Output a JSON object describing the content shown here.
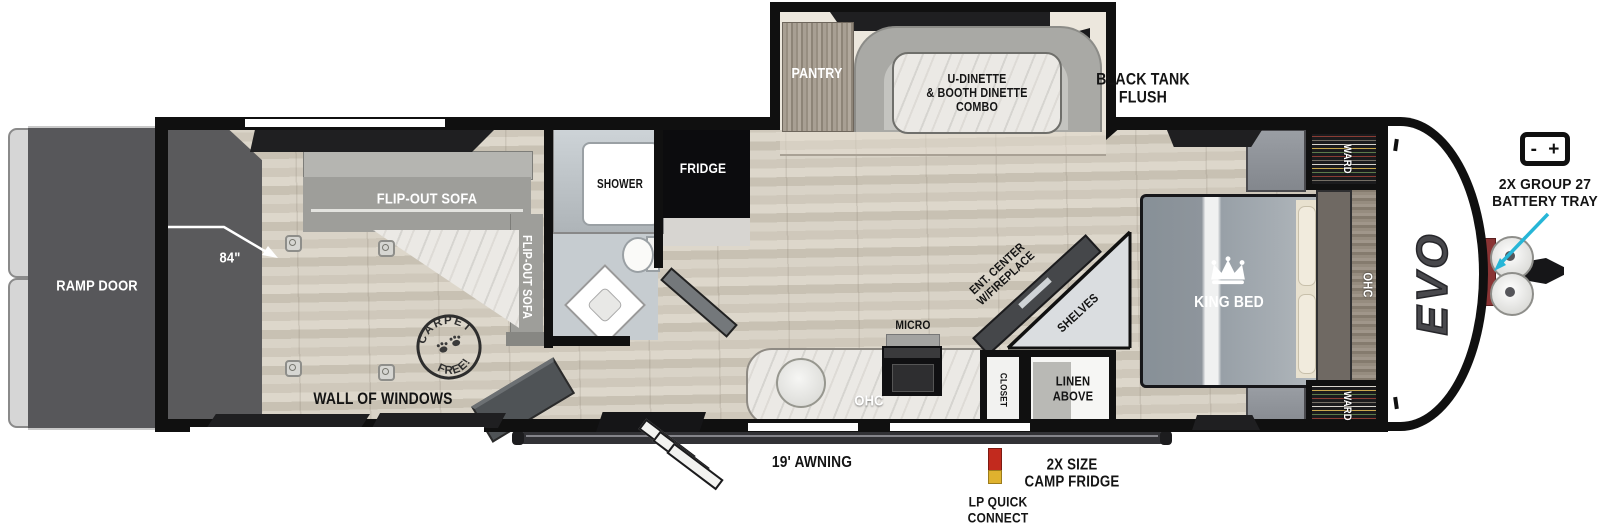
{
  "labels": {
    "ramp_door": "RAMP DOOR",
    "cargo_length": "84\"",
    "sofa_top": "FLIP-OUT SOFA",
    "sofa_side": "FLIP-OUT SOFA",
    "stamp_top": "CARPET",
    "stamp_bottom": "FREE!",
    "wall_of_windows": "WALL OF WINDOWS",
    "shower": "SHOWER",
    "fridge": "FRIDGE",
    "pantry": "PANTRY",
    "dinette_lines": [
      "U-DINETTE",
      "& BOOTH DINETTE",
      "COMBO"
    ],
    "black_tank_lines": [
      "BLACK TANK",
      "FLUSH"
    ],
    "micro": "MICRO",
    "kitchen_ohc": "OHC",
    "ent_center_lines": [
      "ENT. CENTER",
      "W/FIREPLACE"
    ],
    "shelves": "SHELVES",
    "closet": "CLOSET",
    "linen_lines": [
      "LINEN",
      "ABOVE"
    ],
    "king_bed": "KING BED",
    "ward_top": "WARD",
    "ward_bottom": "WARD",
    "bedroom_ohc": "OHC",
    "awning": "19' AWNING",
    "lp_lines": [
      "LP QUICK",
      "CONNECT"
    ],
    "camp_fridge_lines": [
      "2X SIZE",
      "CAMP FRIDGE"
    ],
    "battery_lines": [
      "2X GROUP 27",
      "BATTERY TRAY"
    ],
    "battery_minus": "-",
    "battery_plus": "+",
    "brand": "EVO"
  },
  "colors": {
    "wall": "#101010",
    "accent_arrow": "#27b6d7",
    "lp_red": "#c22a1e",
    "lp_yellow": "#dfb22e",
    "ramp_gray": "#57575a",
    "floor": "#d6cfc3",
    "dark_window": "#1f1f21"
  }
}
